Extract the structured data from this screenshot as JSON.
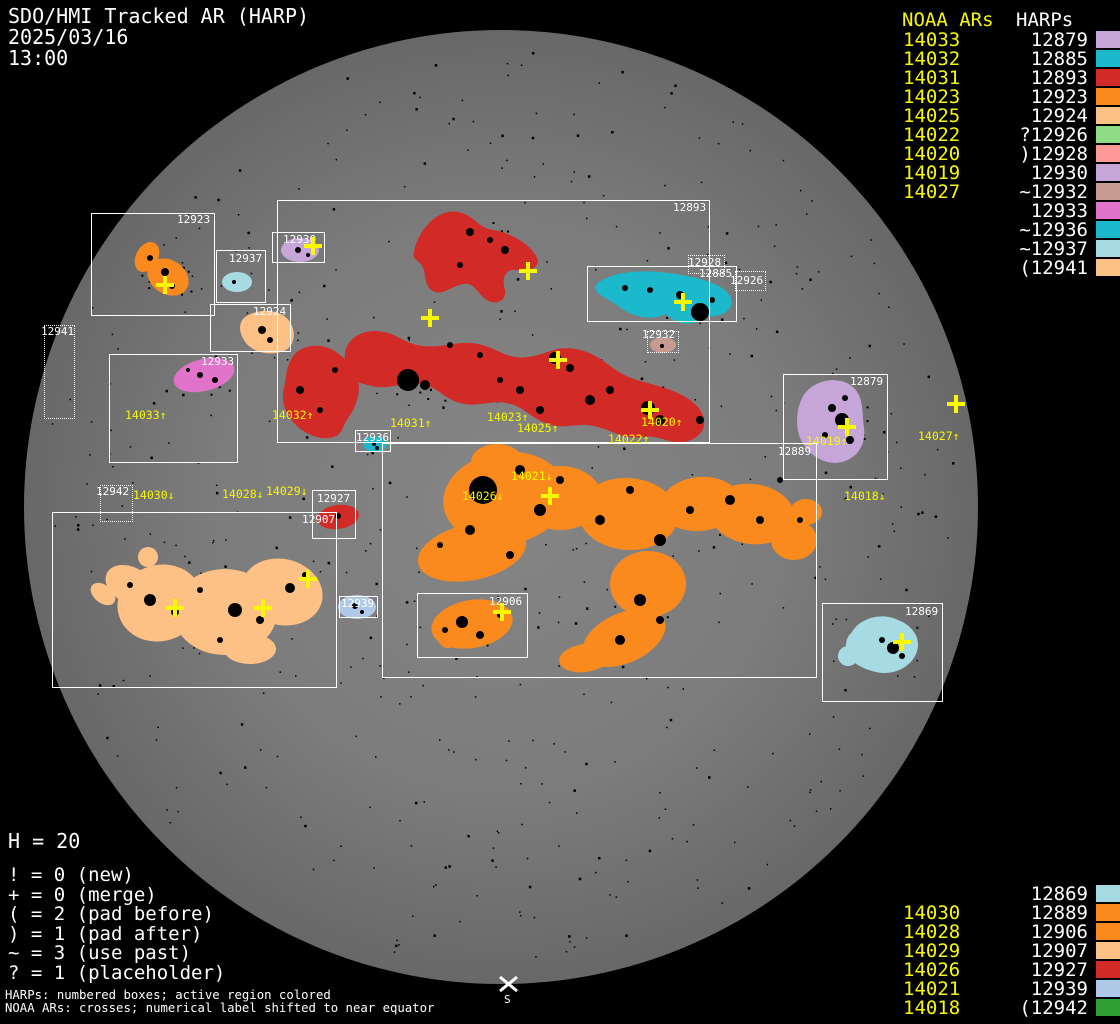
{
  "header": {
    "title": "SDO/HMI Tracked AR (HARP)",
    "date": "2025/03/16",
    "time": "13:00"
  },
  "colors": {
    "lavender": "#c6a6d8",
    "teal": "#1cb8cc",
    "red": "#d22a26",
    "orange": "#fa8a1e",
    "peach": "#fec185",
    "green_light": "#8fdc87",
    "salmon": "#fe9b98",
    "tan": "#c79a92",
    "orchid": "#e273cb",
    "blue_light": "#a6dbe3",
    "steel": "#b1c9e8",
    "green": "#2f9e33",
    "yellow": "#f8f800",
    "white": "#ffffff"
  },
  "top_legend": {
    "noaa_header": "NOAA ARs",
    "harp_header": "HARPs",
    "rows": [
      {
        "noaa": "14033",
        "harp": "12879",
        "color": "#c6a6d8"
      },
      {
        "noaa": "14032",
        "harp": "12885",
        "color": "#1cb8cc"
      },
      {
        "noaa": "14031",
        "harp": "12893",
        "color": "#d22a26"
      },
      {
        "noaa": "14023",
        "harp": "12923",
        "color": "#fa8a1e"
      },
      {
        "noaa": "14025",
        "harp": "12924",
        "color": "#fec185"
      },
      {
        "noaa": "14022",
        "harp": "?12926",
        "color": "#8fdc87"
      },
      {
        "noaa": "14020",
        "harp": ")12928",
        "color": "#fe9b98"
      },
      {
        "noaa": "14019",
        "harp": "12930",
        "color": "#c6a6d8"
      },
      {
        "noaa": "14027",
        "harp": "~12932",
        "color": "#c79a92"
      },
      {
        "noaa": "",
        "harp": "12933",
        "color": "#e273cb"
      },
      {
        "noaa": "",
        "harp": "~12936",
        "color": "#1cb8cc"
      },
      {
        "noaa": "",
        "harp": "~12937",
        "color": "#a6dbe3"
      },
      {
        "noaa": "",
        "harp": "(12941",
        "color": "#fec185"
      }
    ]
  },
  "bottom_legend": {
    "rows": [
      {
        "noaa": "",
        "harp": "12869",
        "color": "#a6dbe3"
      },
      {
        "noaa": "14030",
        "harp": "12889",
        "color": "#fa8a1e"
      },
      {
        "noaa": "14028",
        "harp": "12906",
        "color": "#fa8a1e"
      },
      {
        "noaa": "14029",
        "harp": "12907",
        "color": "#fec185"
      },
      {
        "noaa": "14026",
        "harp": "12927",
        "color": "#d22a26"
      },
      {
        "noaa": "14021",
        "harp": "12939",
        "color": "#b1c9e8"
      },
      {
        "noaa": "14018",
        "harp": "(12942",
        "color": "#2f9e33"
      }
    ]
  },
  "stats": {
    "h_count": "H = 20",
    "flags": [
      "! = 0 (new)",
      "+ = 0 (merge)",
      "( = 2 (pad before)",
      ") = 1 (pad after)",
      "~ = 3 (use past)",
      "? = 1 (placeholder)"
    ]
  },
  "footer": [
    "HARPs: numbered boxes; active region colored",
    "NOAA ARs: crosses; numerical label shifted to near equator"
  ],
  "disk": {
    "south_label": "S",
    "boxes": [
      {
        "label": "12923",
        "x": 91,
        "y": 213,
        "w": 124,
        "h": 103,
        "lx": 177,
        "ly": 214,
        "dotted": false
      },
      {
        "label": "12937",
        "x": 216,
        "y": 250,
        "w": 50,
        "h": 53,
        "lx": 229,
        "ly": 253,
        "dotted": false
      },
      {
        "label": "12930",
        "x": 272,
        "y": 232,
        "w": 53,
        "h": 31,
        "lx": 283,
        "ly": 234,
        "dotted": false
      },
      {
        "label": "12924",
        "x": 210,
        "y": 304,
        "w": 81,
        "h": 48,
        "lx": 253,
        "ly": 306,
        "dotted": false
      },
      {
        "label": "12933",
        "x": 109,
        "y": 354,
        "w": 129,
        "h": 109,
        "lx": 201,
        "ly": 356,
        "dotted": false
      },
      {
        "label": "12941",
        "x": 44,
        "y": 325,
        "w": 31,
        "h": 94,
        "lx": 41,
        "ly": 326,
        "dotted": true
      },
      {
        "label": "12893",
        "x": 277,
        "y": 200,
        "w": 433,
        "h": 243,
        "lx": 673,
        "ly": 202,
        "dotted": false
      },
      {
        "label": "12885",
        "x": 587,
        "y": 266,
        "w": 150,
        "h": 56,
        "lx": 699,
        "ly": 268,
        "dotted": false
      },
      {
        "label": "12928",
        "x": 688,
        "y": 255,
        "w": 37,
        "h": 19,
        "lx": 688,
        "ly": 257,
        "dotted": true
      },
      {
        "label": "12926",
        "x": 735,
        "y": 271,
        "w": 31,
        "h": 20,
        "lx": 730,
        "ly": 275,
        "dotted": true
      },
      {
        "label": "12932",
        "x": 647,
        "y": 331,
        "w": 32,
        "h": 22,
        "lx": 642,
        "ly": 329,
        "dotted": true
      },
      {
        "label": "12936",
        "x": 355,
        "y": 430,
        "w": 36,
        "h": 22,
        "lx": 356,
        "ly": 432,
        "dotted": false
      },
      {
        "label": "12889",
        "x": 382,
        "y": 443,
        "w": 435,
        "h": 235,
        "lx": 778,
        "ly": 446,
        "dotted": false
      },
      {
        "label": "12906",
        "x": 417,
        "y": 593,
        "w": 111,
        "h": 65,
        "lx": 489,
        "ly": 596,
        "dotted": false
      },
      {
        "label": "12927",
        "x": 312,
        "y": 490,
        "w": 44,
        "h": 49,
        "lx": 317,
        "ly": 493,
        "dotted": false
      },
      {
        "label": "12907",
        "x": 52,
        "y": 512,
        "w": 285,
        "h": 176,
        "lx": 302,
        "ly": 514,
        "dotted": false
      },
      {
        "label": "12942",
        "x": 100,
        "y": 485,
        "w": 33,
        "h": 37,
        "lx": 96,
        "ly": 486,
        "dotted": true
      },
      {
        "label": "12939",
        "x": 339,
        "y": 596,
        "w": 39,
        "h": 22,
        "lx": 341,
        "ly": 598,
        "dotted": false
      },
      {
        "label": "12879",
        "x": 783,
        "y": 374,
        "w": 105,
        "h": 106,
        "lx": 850,
        "ly": 376,
        "dotted": false
      },
      {
        "label": "12869",
        "x": 822,
        "y": 603,
        "w": 121,
        "h": 99,
        "lx": 905,
        "ly": 606,
        "dotted": false
      }
    ],
    "crosses": [
      {
        "x": 165,
        "y": 285
      },
      {
        "x": 313,
        "y": 246
      },
      {
        "x": 528,
        "y": 271
      },
      {
        "x": 430,
        "y": 318
      },
      {
        "x": 558,
        "y": 360
      },
      {
        "x": 650,
        "y": 410
      },
      {
        "x": 683,
        "y": 302
      },
      {
        "x": 847,
        "y": 427
      },
      {
        "x": 956,
        "y": 404
      },
      {
        "x": 550,
        "y": 496
      },
      {
        "x": 502,
        "y": 612
      },
      {
        "x": 175,
        "y": 608
      },
      {
        "x": 263,
        "y": 608
      },
      {
        "x": 308,
        "y": 579
      },
      {
        "x": 902,
        "y": 642
      }
    ],
    "noaa_labels": [
      {
        "text": "14033↑",
        "x": 125,
        "y": 410
      },
      {
        "text": "14032↑",
        "x": 272,
        "y": 410
      },
      {
        "text": "14031↑",
        "x": 390,
        "y": 418
      },
      {
        "text": "14023↑",
        "x": 487,
        "y": 412
      },
      {
        "text": "14025↑",
        "x": 517,
        "y": 423
      },
      {
        "text": "14022↑",
        "x": 608,
        "y": 434
      },
      {
        "text": "14020↑",
        "x": 641,
        "y": 417
      },
      {
        "text": "14019↑",
        "x": 806,
        "y": 436
      },
      {
        "text": "14018↓",
        "x": 844,
        "y": 491
      },
      {
        "text": "14027↑",
        "x": 918,
        "y": 431
      },
      {
        "text": "14030↓",
        "x": 133,
        "y": 490
      },
      {
        "text": "14028↓",
        "x": 222,
        "y": 489
      },
      {
        "text": "14029↓",
        "x": 266,
        "y": 486
      },
      {
        "text": "14021↓",
        "x": 511,
        "y": 471
      },
      {
        "text": "14026↓",
        "x": 462,
        "y": 491
      }
    ]
  }
}
